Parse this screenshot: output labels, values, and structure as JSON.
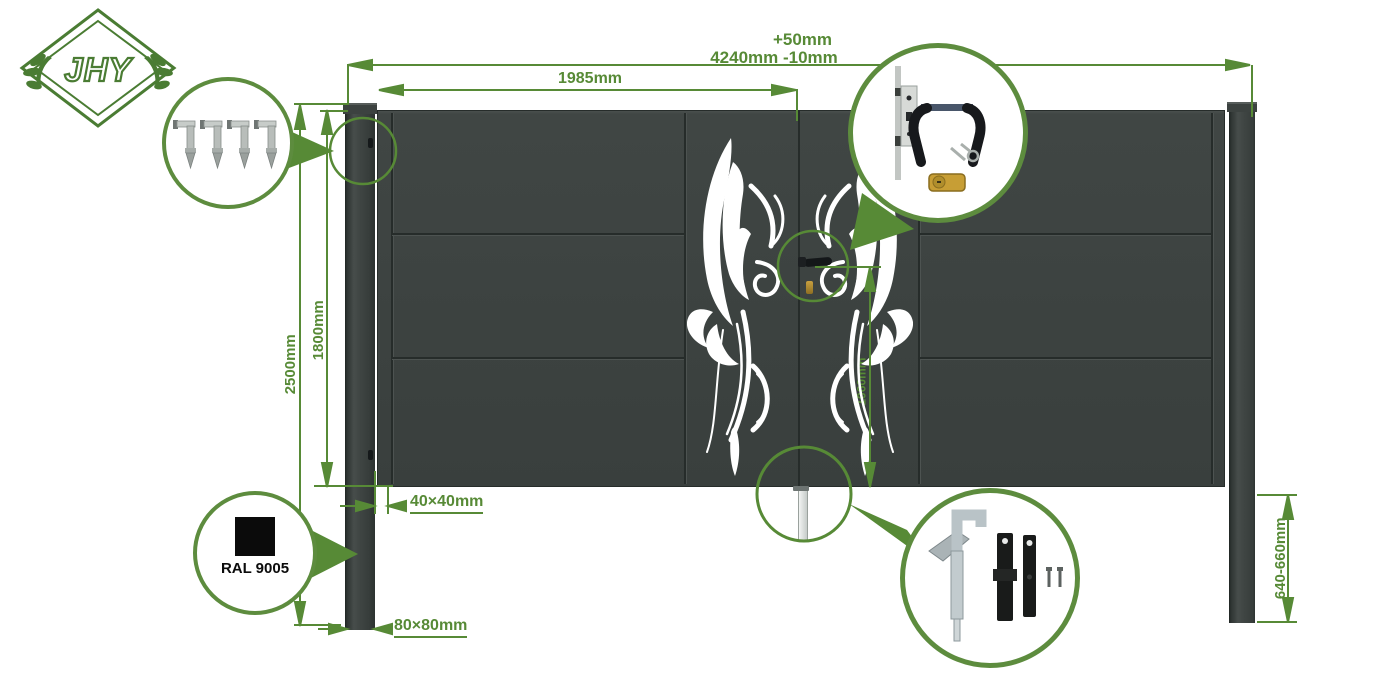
{
  "brand": {
    "logo_text": "JHY"
  },
  "colors": {
    "accent_green": "#578a36",
    "callout_border_green": "#5d8c3e",
    "gate_body": "#3d4341",
    "swatch_black": "#0b0b0b"
  },
  "annotations": {
    "width_tolerance": "+50mm",
    "overall_width": "4240mm -10mm",
    "leaf_width": "1985mm",
    "total_height": "2500mm",
    "gate_height": "1800mm",
    "handle_height": "1060mm",
    "post_embed_depth": "640-660mm",
    "frame_profile": "40×40mm",
    "post_profile": "80×80mm"
  },
  "swatch": {
    "label": "RAL 9005"
  },
  "callouts": {
    "hinges": {
      "icon": "hinge-icon",
      "items": 4
    },
    "lock": {
      "icons": [
        "mortise-lock-icon",
        "handle-pair-icon",
        "keys-icon",
        "euro-cylinder-icon"
      ]
    },
    "drop_bolt": {
      "icons": [
        "drop-bolt-icon",
        "mounting-plate-icon",
        "mounting-plate-icon",
        "screw-icon",
        "screw-icon"
      ]
    },
    "color": {
      "icon": "color-swatch-icon"
    }
  }
}
